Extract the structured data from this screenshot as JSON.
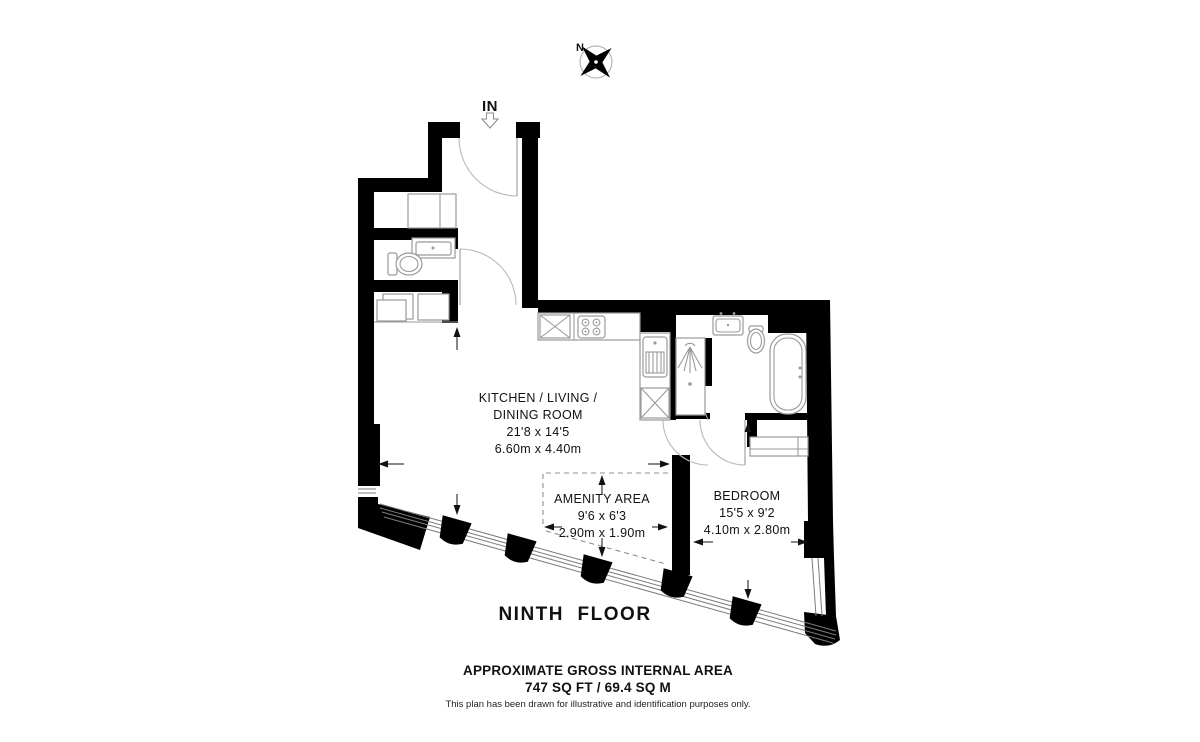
{
  "compass": {
    "north_label": "N"
  },
  "entrance": {
    "label": "IN"
  },
  "rooms": {
    "kitchen_living_dining": {
      "line1": "KITCHEN / LIVING /",
      "line2": "DINING ROOM",
      "dimensions_imperial": "21'8 x 14'5",
      "dimensions_metric": "6.60m x 4.40m"
    },
    "amenity": {
      "name": "AMENITY AREA",
      "dimensions_imperial": "9'6 x 6'3",
      "dimensions_metric": "2.90m x 1.90m"
    },
    "bedroom": {
      "name": "BEDROOM",
      "dimensions_imperial": "15'5 x 9'2",
      "dimensions_metric": "4.10m x 2.80m"
    }
  },
  "floor_title": "NINTH  FLOOR",
  "footer": {
    "heading": "APPROXIMATE GROSS INTERNAL AREA",
    "area": "747 SQ FT / 69.4 SQ M",
    "disclaimer": "This plan has been drawn for illustrative and identification purposes only."
  },
  "colors": {
    "wall": "#000000",
    "fixture_stroke": "#9a9a9a",
    "text": "#111111",
    "background": "#ffffff"
  }
}
